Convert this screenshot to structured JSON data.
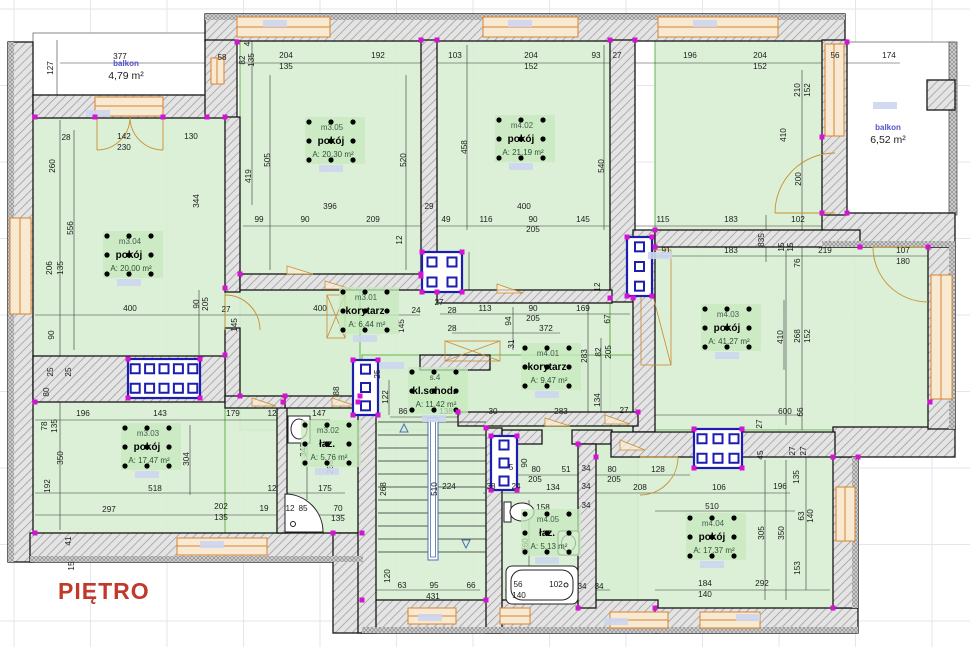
{
  "title": "PIĘTRO",
  "colors": {
    "room_fill": "#d8efd2",
    "room_highlight": "#c7e9bd",
    "wall_hatch_bg": "#e4e4e4",
    "wall_hatch_line": "#979797",
    "window_orange": "#d9822f",
    "window_fill": "#f8e9d3",
    "shaft_navy": "#1d1db0",
    "node_magenta": "#d414d4",
    "title_red": "#c0392b",
    "grid_gray": "#e3e6ec",
    "tag_blue": "#ccd6f0"
  },
  "balconies": [
    {
      "name": "balkon",
      "area": "4,79 m²",
      "x": 126,
      "y": 66
    },
    {
      "name": "balkon",
      "area": "6,52 m²",
      "x": 888,
      "y": 130
    }
  ],
  "rooms": [
    {
      "id": "m3.05",
      "type": "pokój",
      "area": "A: 20,30 m²",
      "x": 331,
      "y": 141
    },
    {
      "id": "m4.02",
      "type": "pokój",
      "area": "A: 21,19 m²",
      "x": 521,
      "y": 139
    },
    {
      "id": "m3.04",
      "type": "pokój",
      "area": "A: 20,00 m²",
      "x": 129,
      "y": 255
    },
    {
      "id": "m3.01",
      "type": "korytarz",
      "area": "A: 6,44 m²",
      "x": 365,
      "y": 311
    },
    {
      "id": "m4.01",
      "type": "korytarz",
      "area": "A: 9,47 m²",
      "x": 547,
      "y": 367
    },
    {
      "id": "m4.03",
      "type": "pokój",
      "area": "A: 41,27 m²",
      "x": 727,
      "y": 328
    },
    {
      "id": "s.4",
      "type": "kl.schod.",
      "area": "A: 11,42 m²",
      "x": 434,
      "y": 391
    },
    {
      "id": "m3.03",
      "type": "pokój",
      "area": "A: 17,47 m²",
      "x": 147,
      "y": 447
    },
    {
      "id": "m3.02",
      "type": "łaz.",
      "area": "A: 5,76 m²",
      "x": 327,
      "y": 444
    },
    {
      "id": "m4.05",
      "type": "łaz.",
      "area": "A: 5,13 m²",
      "x": 547,
      "y": 533
    },
    {
      "id": "m4.04",
      "type": "pokój",
      "area": "A: 17,37 m²",
      "x": 712,
      "y": 537
    }
  ],
  "shafts": [
    {
      "name": "vent-shaft",
      "x": 422,
      "y": 252,
      "w": 40,
      "h": 40,
      "rows": 2,
      "cols": 2
    },
    {
      "name": "vent-shaft",
      "x": 627,
      "y": 237,
      "w": 25,
      "h": 59,
      "rows": 3,
      "cols": 1
    },
    {
      "name": "vent-shaft",
      "x": 128,
      "y": 359,
      "w": 72,
      "h": 39,
      "rows": 2,
      "cols": 5
    },
    {
      "name": "vent-shaft",
      "x": 353,
      "y": 360,
      "w": 25,
      "h": 55,
      "rows": 3,
      "cols": 1
    },
    {
      "name": "vent-shaft",
      "x": 491,
      "y": 436,
      "w": 26,
      "h": 54,
      "rows": 3,
      "cols": 1
    },
    {
      "name": "vent-shaft",
      "x": 694,
      "y": 429,
      "w": 48,
      "h": 39,
      "rows": 2,
      "cols": 3
    }
  ],
  "dims": [
    [
      "377",
      120,
      59,
      0
    ],
    [
      "127",
      53,
      68,
      1
    ],
    [
      "58",
      222,
      60,
      0
    ],
    [
      "82",
      245,
      60,
      1
    ],
    [
      "135",
      254,
      60,
      1
    ],
    [
      "4",
      250,
      44,
      1
    ],
    [
      "204",
      286,
      58,
      0
    ],
    [
      "135",
      286,
      69,
      0
    ],
    [
      "192",
      378,
      58,
      0
    ],
    [
      "103",
      455,
      58,
      0
    ],
    [
      "204",
      531,
      58,
      0
    ],
    [
      "152",
      531,
      69,
      0
    ],
    [
      "93",
      596,
      58,
      0
    ],
    [
      "27",
      617,
      58,
      0
    ],
    [
      "196",
      690,
      58,
      0
    ],
    [
      "204",
      760,
      58,
      0
    ],
    [
      "152",
      760,
      69,
      0
    ],
    [
      "56",
      835,
      58,
      0
    ],
    [
      "174",
      889,
      58,
      0
    ],
    [
      "28",
      66,
      140,
      0
    ],
    [
      "142",
      124,
      139,
      0
    ],
    [
      "230",
      124,
      150,
      0
    ],
    [
      "130",
      191,
      139,
      0
    ],
    [
      "260",
      55,
      166,
      1
    ],
    [
      "556",
      73,
      228,
      1
    ],
    [
      "206",
      52,
      268,
      1
    ],
    [
      "135",
      63,
      268,
      1
    ],
    [
      "90",
      54,
      335,
      1
    ],
    [
      "25",
      53,
      372,
      1
    ],
    [
      "25",
      71,
      372,
      1
    ],
    [
      "80",
      49,
      392,
      1
    ],
    [
      "78",
      47,
      426,
      1
    ],
    [
      "135",
      57,
      426,
      1
    ],
    [
      "350",
      63,
      458,
      1
    ],
    [
      "192",
      50,
      486,
      1
    ],
    [
      "41",
      71,
      541,
      1
    ],
    [
      "15",
      74,
      566,
      1
    ],
    [
      "505",
      270,
      160,
      1
    ],
    [
      "419",
      251,
      176,
      1
    ],
    [
      "344",
      199,
      201,
      1
    ],
    [
      "520",
      406,
      160,
      1
    ],
    [
      "458",
      467,
      147,
      1
    ],
    [
      "540",
      604,
      166,
      1
    ],
    [
      "396",
      330,
      209,
      0
    ],
    [
      "29",
      429,
      209,
      0
    ],
    [
      "400",
      524,
      209,
      0
    ],
    [
      "99",
      259,
      222,
      0
    ],
    [
      "90",
      305,
      222,
      0
    ],
    [
      "209",
      373,
      222,
      0
    ],
    [
      "49",
      446,
      222,
      0
    ],
    [
      "116",
      486,
      222,
      0
    ],
    [
      "90",
      533,
      222,
      0
    ],
    [
      "205",
      533,
      232,
      0
    ],
    [
      "145",
      583,
      222,
      0
    ],
    [
      "115",
      663,
      222,
      0
    ],
    [
      "183",
      731,
      222,
      0
    ],
    [
      "102",
      798,
      222,
      0
    ],
    [
      "835",
      764,
      240,
      1
    ],
    [
      "210",
      800,
      90,
      1
    ],
    [
      "152",
      810,
      90,
      1
    ],
    [
      "410",
      786,
      135,
      1
    ],
    [
      "200",
      801,
      179,
      1
    ],
    [
      "15",
      784,
      247,
      1
    ],
    [
      "15",
      793,
      247,
      1
    ],
    [
      "76",
      800,
      263,
      1
    ],
    [
      "91",
      666,
      253,
      0
    ],
    [
      "183",
      731,
      253,
      0
    ],
    [
      "219",
      825,
      253,
      0
    ],
    [
      "107",
      903,
      253,
      0
    ],
    [
      "180",
      903,
      264,
      0
    ],
    [
      "400",
      130,
      311,
      0
    ],
    [
      "400",
      320,
      311,
      0
    ],
    [
      "90",
      199,
      304,
      1
    ],
    [
      "205",
      208,
      304,
      1
    ],
    [
      "27",
      226,
      312,
      0
    ],
    [
      "145",
      237,
      325,
      1
    ],
    [
      "12",
      402,
      240,
      1
    ],
    [
      "24",
      416,
      313,
      0
    ],
    [
      "27",
      439,
      305,
      0
    ],
    [
      "28",
      452,
      313,
      0
    ],
    [
      "113",
      485,
      311,
      0
    ],
    [
      "90",
      533,
      311,
      0
    ],
    [
      "205",
      533,
      321,
      0
    ],
    [
      "169",
      583,
      311,
      0
    ],
    [
      "372",
      546,
      331,
      0
    ],
    [
      "28",
      452,
      331,
      0
    ],
    [
      "94",
      511,
      321,
      1
    ],
    [
      "31",
      514,
      344,
      1
    ],
    [
      "145",
      404,
      326,
      1
    ],
    [
      "67",
      610,
      319,
      1
    ],
    [
      "82",
      601,
      352,
      1
    ],
    [
      "205",
      611,
      352,
      1
    ],
    [
      "283",
      587,
      356,
      1
    ],
    [
      "12",
      600,
      287,
      1
    ],
    [
      "134",
      600,
      400,
      1
    ],
    [
      "27",
      624,
      413,
      0
    ],
    [
      "283",
      561,
      414,
      0
    ],
    [
      "30",
      493,
      414,
      0
    ],
    [
      "138",
      446,
      414,
      0
    ],
    [
      "86",
      403,
      414,
      0
    ],
    [
      "122",
      388,
      397,
      1
    ],
    [
      "88",
      339,
      391,
      1
    ],
    [
      "25",
      380,
      374,
      1
    ],
    [
      "410",
      783,
      337,
      1
    ],
    [
      "268",
      800,
      336,
      1
    ],
    [
      "152",
      810,
      336,
      1
    ],
    [
      "600",
      785,
      414,
      0
    ],
    [
      "66",
      803,
      412,
      1
    ],
    [
      "27",
      762,
      424,
      1
    ],
    [
      "196",
      83,
      416,
      0
    ],
    [
      "143",
      160,
      416,
      0
    ],
    [
      "179",
      233,
      416,
      0
    ],
    [
      "12",
      272,
      416,
      0
    ],
    [
      "147",
      319,
      416,
      0
    ],
    [
      "343",
      306,
      450,
      1
    ],
    [
      "255",
      333,
      467,
      1
    ],
    [
      "304",
      189,
      459,
      1
    ],
    [
      "518",
      155,
      491,
      0
    ],
    [
      "12",
      272,
      491,
      0
    ],
    [
      "175",
      325,
      491,
      0
    ],
    [
      "297",
      109,
      512,
      0
    ],
    [
      "202",
      221,
      509,
      0
    ],
    [
      "135",
      221,
      520,
      0
    ],
    [
      "19",
      264,
      511,
      0
    ],
    [
      "12",
      290,
      511,
      0
    ],
    [
      "85",
      303,
      511,
      0
    ],
    [
      "70",
      338,
      511,
      0
    ],
    [
      "135",
      338,
      521,
      0
    ],
    [
      "224",
      449,
      489,
      0
    ],
    [
      "510",
      437,
      489,
      1
    ],
    [
      "268",
      386,
      489,
      1
    ],
    [
      "120",
      390,
      576,
      1
    ],
    [
      "63",
      402,
      588,
      0
    ],
    [
      "95",
      434,
      588,
      0
    ],
    [
      "66",
      471,
      588,
      0
    ],
    [
      "431",
      433,
      599,
      0
    ],
    [
      "90",
      527,
      463,
      1
    ],
    [
      "5",
      511,
      470,
      0
    ],
    [
      "80",
      536,
      472,
      0
    ],
    [
      "205",
      535,
      482,
      0
    ],
    [
      "51",
      566,
      472,
      0
    ],
    [
      "34",
      586,
      471,
      0
    ],
    [
      "80",
      612,
      472,
      0
    ],
    [
      "205",
      614,
      482,
      0
    ],
    [
      "128",
      658,
      472,
      0
    ],
    [
      "38",
      491,
      489,
      0
    ],
    [
      "24",
      516,
      489,
      0
    ],
    [
      "134",
      553,
      490,
      0
    ],
    [
      "34",
      586,
      489,
      0
    ],
    [
      "158",
      543,
      510,
      0
    ],
    [
      "34",
      586,
      508,
      0
    ],
    [
      "260",
      528,
      545,
      1
    ],
    [
      "56",
      518,
      587,
      0
    ],
    [
      "140",
      519,
      598,
      0
    ],
    [
      "102",
      556,
      587,
      0
    ],
    [
      "34",
      582,
      589,
      0
    ],
    [
      "34",
      599,
      589,
      0
    ],
    [
      "208",
      640,
      490,
      0
    ],
    [
      "106",
      719,
      490,
      0
    ],
    [
      "196",
      780,
      489,
      0
    ],
    [
      "510",
      712,
      509,
      0
    ],
    [
      "305",
      764,
      533,
      1
    ],
    [
      "350",
      784,
      533,
      1
    ],
    [
      "63",
      804,
      516,
      1
    ],
    [
      "140",
      813,
      516,
      1
    ],
    [
      "135",
      799,
      477,
      1
    ],
    [
      "45",
      763,
      455,
      1
    ],
    [
      "27",
      795,
      451,
      1
    ],
    [
      "27",
      806,
      451,
      1
    ],
    [
      "153",
      800,
      568,
      1
    ],
    [
      "184",
      705,
      586,
      0
    ],
    [
      "140",
      705,
      597,
      0
    ],
    [
      "292",
      762,
      586,
      0
    ]
  ]
}
